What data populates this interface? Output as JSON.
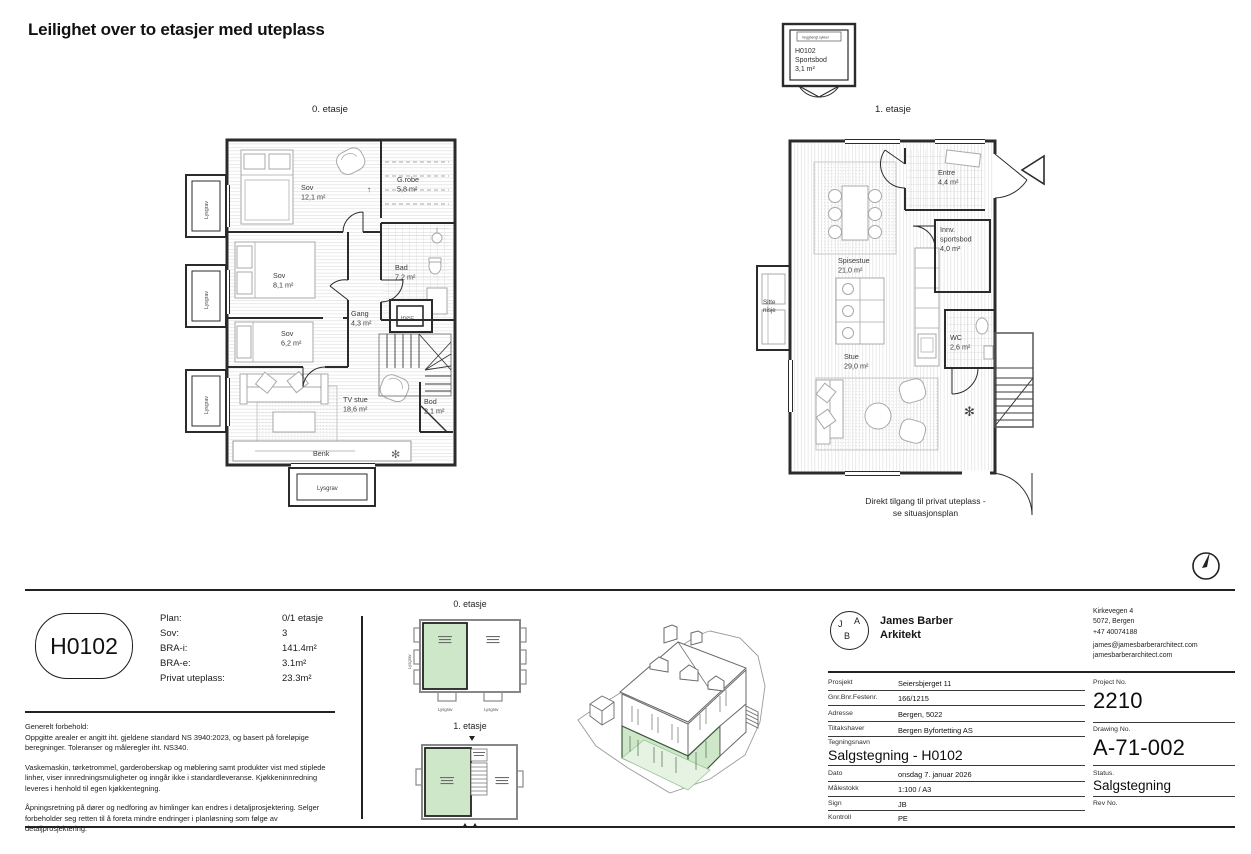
{
  "sheet": {
    "title": "Leilighet over to etasjer med uteplass"
  },
  "colors": {
    "accent_green": "#cde7c8",
    "wall": "#2b2b2b"
  },
  "plan0": {
    "label": "0. etasje",
    "rooms": {
      "sov1": {
        "name": "Sov",
        "area": "12,1 m²"
      },
      "grobe": {
        "name": "G.robe",
        "area": "5,8 m²"
      },
      "sov2": {
        "name": "Sov",
        "area": "8,1 m²"
      },
      "bad": {
        "name": "Bad",
        "area": "7,2 m²"
      },
      "gang": {
        "name": "Gang",
        "area": "4,3 m²"
      },
      "sov3": {
        "name": "Sov",
        "area": "6,2 m²"
      },
      "tv_stue": {
        "name": "TV stue",
        "area": "18,6 m²"
      },
      "bod": {
        "name": "Bod",
        "area": "2,1 m²"
      }
    },
    "benk_label": "Benk",
    "hvac_label": "HVAC",
    "lysgrav_label": "Lysgrav"
  },
  "plan1": {
    "label": "1. etasje",
    "rooms": {
      "entre": {
        "name": "Entre",
        "area": "4,4 m²"
      },
      "innv_sportsbod": {
        "name": "Innv.",
        "name2": "sportsbod",
        "area": "4,0 m²"
      },
      "spisestue": {
        "name": "Spisestue",
        "area": "21,0 m²"
      },
      "wc": {
        "name": "WC",
        "area": "2,6 m²"
      },
      "stue": {
        "name": "Stue",
        "area": "29,0 m²"
      }
    },
    "sitte_nisje": {
      "line1": "Sitte",
      "line2": "nisje"
    },
    "caption": {
      "line1": "Direkt tilgang til privat uteplass -",
      "line2": "se situasjonsplan"
    }
  },
  "sportsbod_box": {
    "top_label": "Vegghengt sykkel",
    "line1": "H0102",
    "line2": "Sportsbod",
    "line3": "3,1 m²"
  },
  "unit_summary": {
    "unit_id": "H0102",
    "rows": [
      {
        "label": "Plan:",
        "value": "0/1 etasje"
      },
      {
        "label": "Sov:",
        "value": "3"
      },
      {
        "label": "BRA-i:",
        "value": "141.4m²"
      },
      {
        "label": "BRA-e:",
        "value": "3.1m²"
      },
      {
        "label": "Privat uteplass:",
        "value": "23.3m²"
      }
    ]
  },
  "disclaimer": {
    "heading": "Generelt forbehold:",
    "p1": "Oppgitte arealer er angitt iht. gjeldene standard NS 3940:2023, og basert på foreløpige beregninger. Toleranser og måleregler iht. NS340.",
    "p2": "Vaskemaskin, tørketrommel, garderoberskap og møblering samt produkter vist med stiplede linher, viser innredningsmuligheter og inngår ikke i standardleveranse. Kjøkkeninnredning leveres i henhold til egen kjøkkentegning.",
    "p3": "Åpningsretning på dører og nedforing av himlinger kan endres i detaljprosjektering. Selger forbeholder seg retten til å foreta mindre endringer i planløsning som følge av detaljprosjektering."
  },
  "keyplans": {
    "plan0_label": "0. etasje",
    "plan1_label": "1. etasje",
    "lysgrav_label": "Lysgrav"
  },
  "titleblock": {
    "logo": {
      "l1": "J",
      "l2": "A",
      "l3": "B"
    },
    "firm_line1": "James Barber",
    "firm_line2": "Arkitekt",
    "contact": [
      "Kirkevegen 4",
      "5072, Bergen",
      "+47 40074188",
      "james@jamesbarberarchitect.com",
      "jamesbarberarchitect.com"
    ],
    "fields": [
      {
        "label": "Prosjekt",
        "value": "Seiersbjerget 11"
      },
      {
        "label": "Gnr.Bnr.Festenr.",
        "value": "166/1215"
      },
      {
        "label": "Adresse",
        "value": "Bergen, 5022"
      },
      {
        "label": "Tiltakshaver",
        "value": "Bergen Byfortetting AS"
      }
    ],
    "tegningsnavn_label": "Tegningsnavn",
    "tegningsnavn_value": "Salgstegning - H0102",
    "fields2": [
      {
        "label": "Dato",
        "value": "onsdag 7. januar 2026"
      },
      {
        "label": "Målestokk",
        "value": "1:100 / A3"
      },
      {
        "label": "Sign",
        "value": "JB"
      },
      {
        "label": "Kontroll",
        "value": "PE"
      }
    ],
    "project_no_label": "Project No.",
    "project_no": "2210",
    "drawing_no_label": "Drawing No.",
    "drawing_no": "A-71-002",
    "status_label": "Status.",
    "status": "Salgstegning",
    "rev_label": "Rev No."
  }
}
